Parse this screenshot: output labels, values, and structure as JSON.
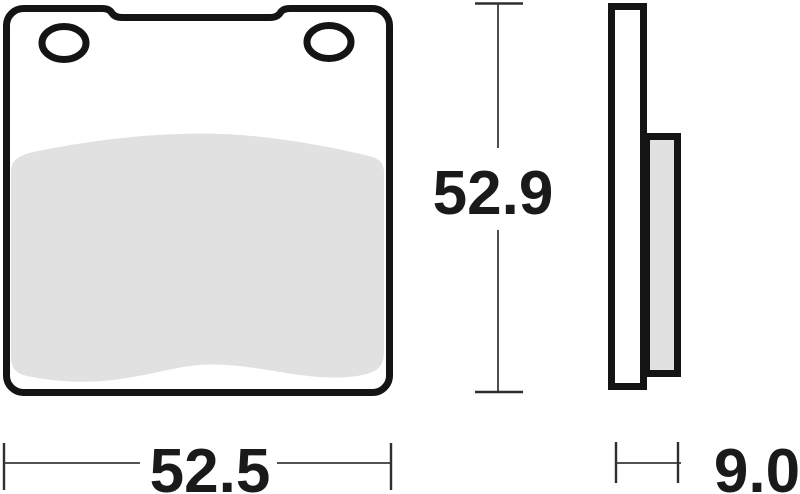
{
  "dimensions": {
    "height_label": "52.9",
    "width_label": "52.5",
    "thickness_label": "9.0"
  },
  "colors": {
    "part_outline": "#141414",
    "friction_material_fill": "#e1e1e1",
    "dimension_line": "#3a3a3a",
    "label_text": "#1a1a1a",
    "background": "#ffffff"
  }
}
